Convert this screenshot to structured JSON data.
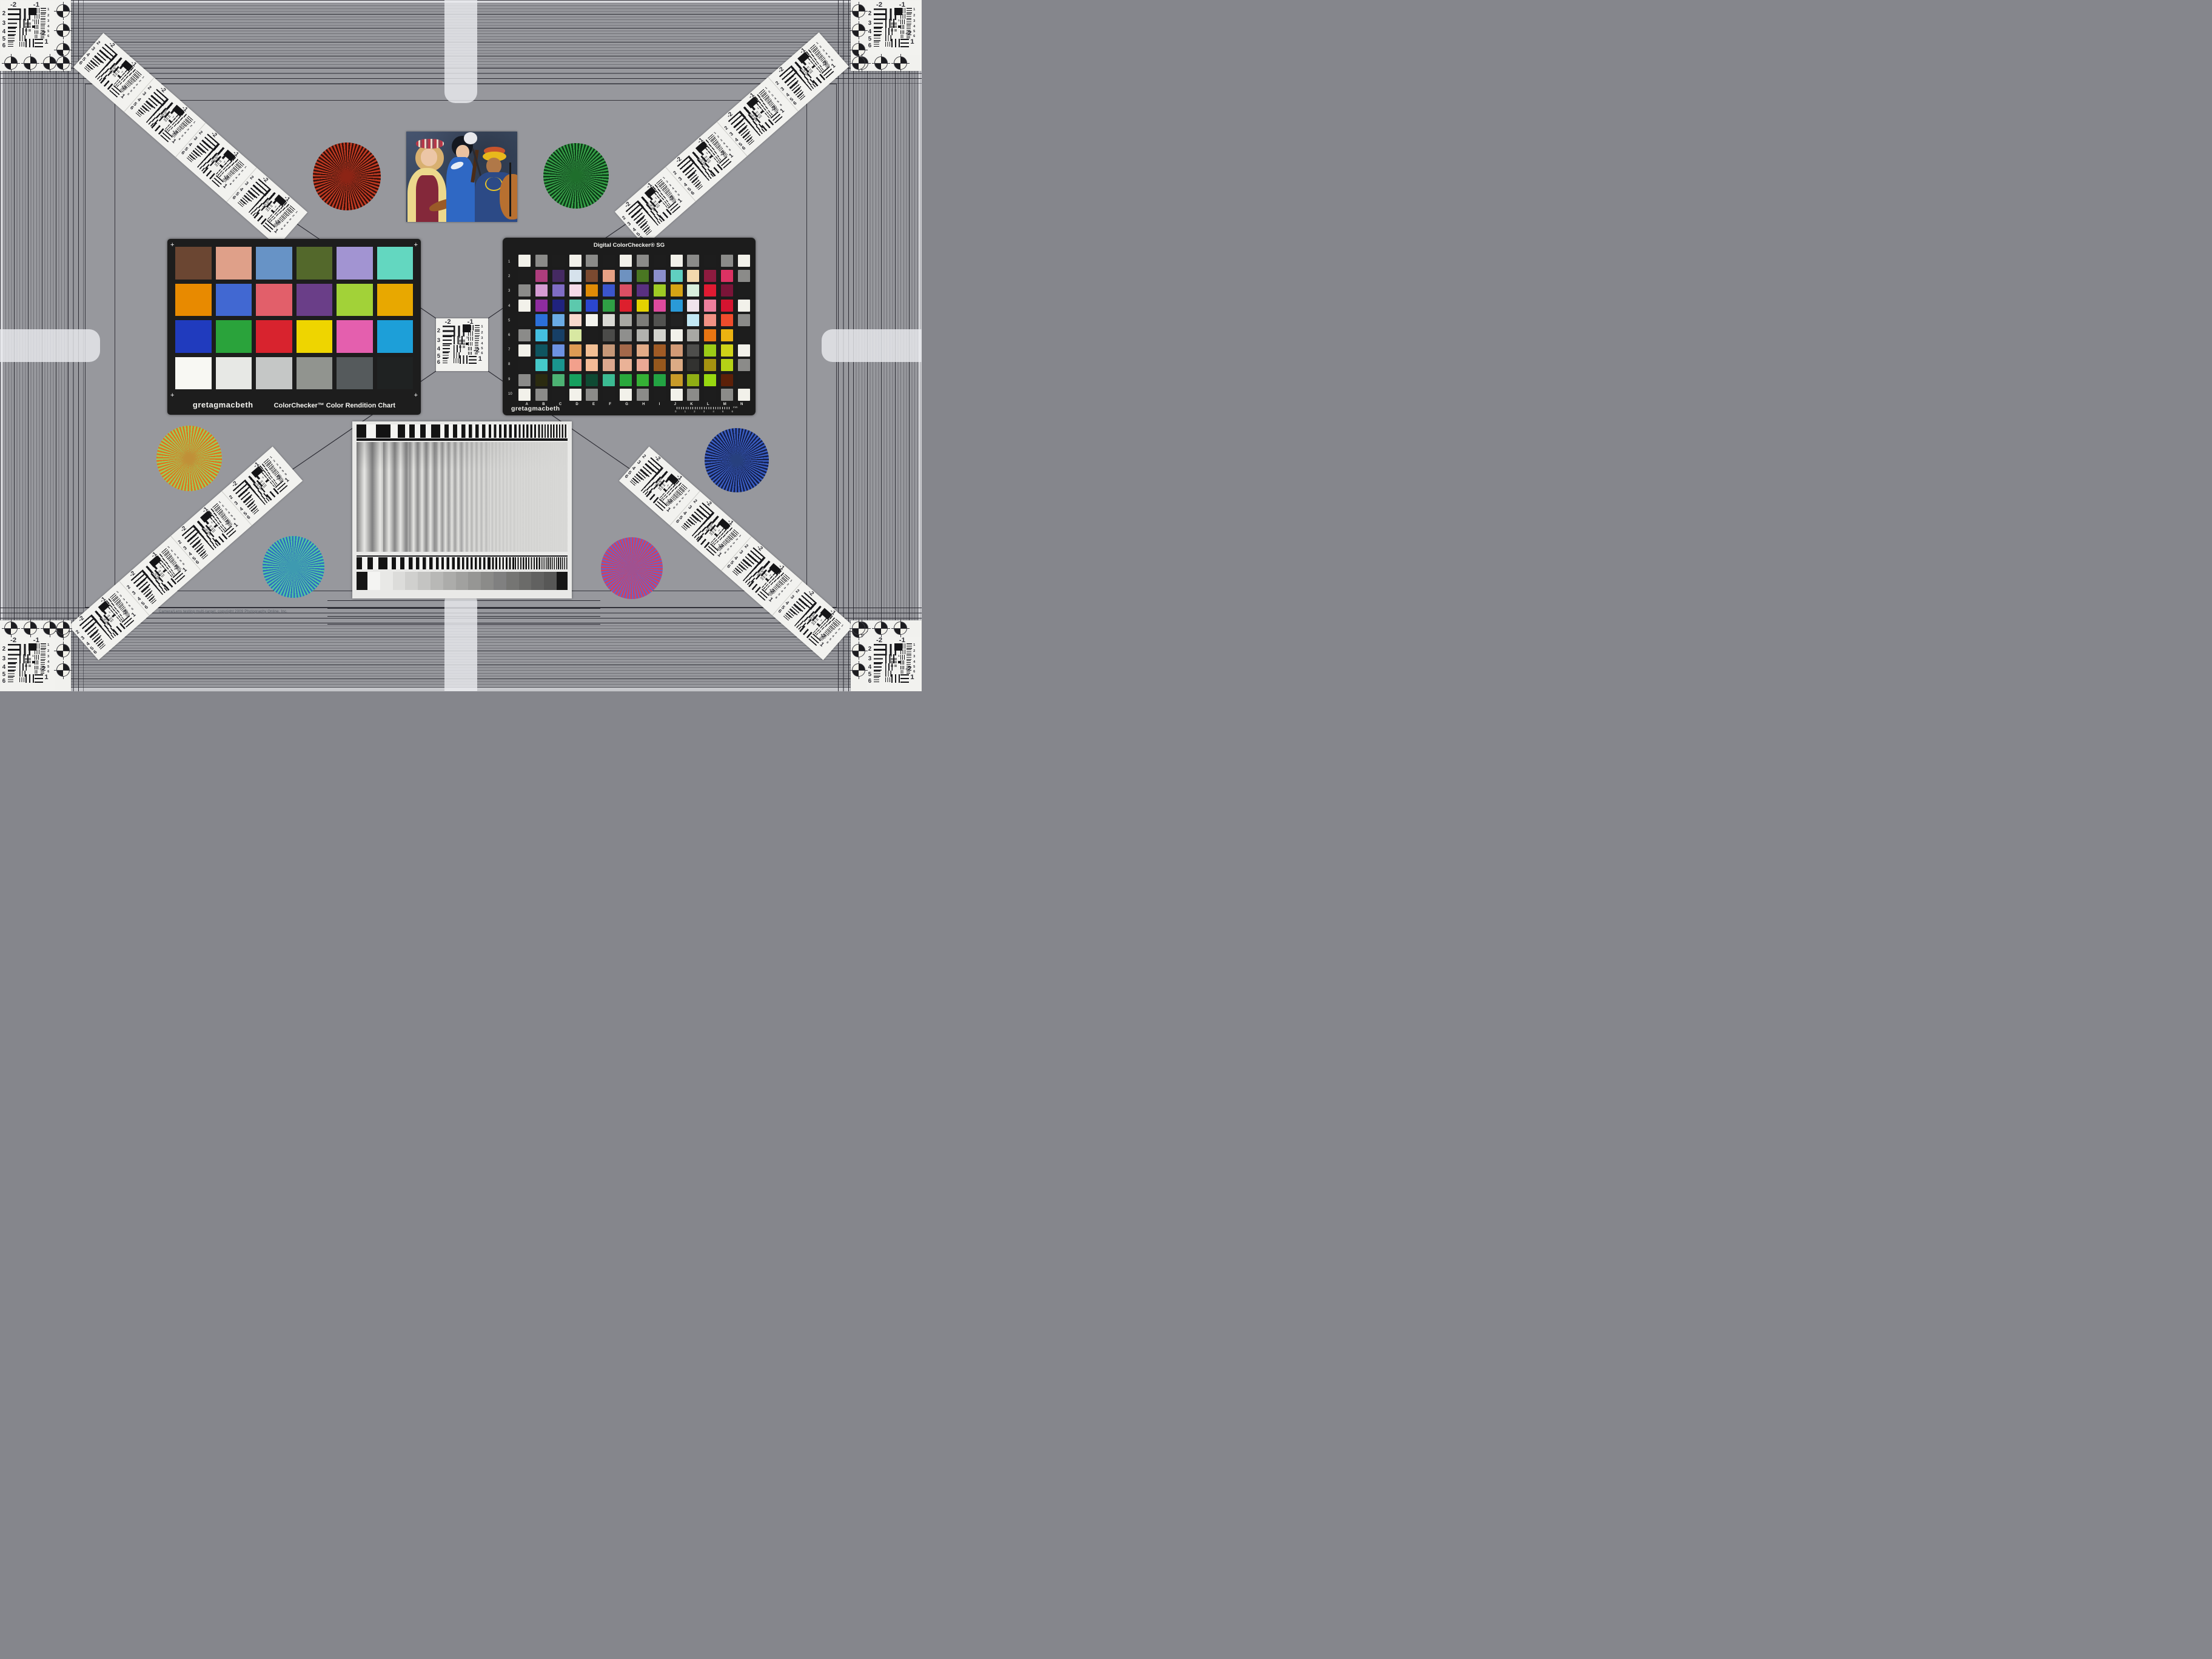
{
  "meta": {
    "copyright": "Camera/Lens testing multi-target, copyright 2009 Photography Online, Inc."
  },
  "colors": {
    "background": "#97989d",
    "border_line": "#23232a",
    "card_black": "#1d1d1d",
    "target_white": "#f2f2ef",
    "tab_white": "#ebecf0"
  },
  "colorchecker": {
    "brand": "gretagmacbeth",
    "title": "ColorChecker™ Color Rendition Chart",
    "corner_mark": "+",
    "patches": [
      "#6b4632",
      "#dfa089",
      "#6793c6",
      "#53682b",
      "#a294d2",
      "#63d7c0",
      "#e88a00",
      "#4168d2",
      "#e25f6a",
      "#6a3e88",
      "#a2d238",
      "#e8a800",
      "#203bbe",
      "#2aa33b",
      "#d8232e",
      "#eed500",
      "#e45fae",
      "#1d9fd8",
      "#f8f8f3",
      "#e7e8e5",
      "#c5c7c6",
      "#91948f",
      "#555a5c",
      "#1f2222"
    ]
  },
  "sg": {
    "title": "Digital ColorChecker® SG",
    "brand": "gretagmacbeth",
    "row_labels": [
      "1",
      "2",
      "3",
      "4",
      "5",
      "6",
      "7",
      "8",
      "9",
      "10"
    ],
    "col_labels": [
      "A",
      "B",
      "C",
      "D",
      "E",
      "F",
      "G",
      "H",
      "I",
      "J",
      "K",
      "L",
      "M",
      "N"
    ],
    "ruler_numbers": [
      "0",
      "1",
      "2",
      "3",
      "4",
      "5",
      "6"
    ],
    "ruler_unit": "mm",
    "grid": [
      [
        "#f2f1ea",
        "#8b8b89",
        "#1d1d1d",
        "#f2f1ea",
        "#8b8b89",
        "#1d1d1d",
        "#f2f1ea",
        "#8b8b89",
        "#1d1d1d",
        "#f2f1ea",
        "#8b8b89",
        "#1d1d1d",
        "#8b8b89",
        "#f2f1ea"
      ],
      [
        "#1d1d1d",
        "#ae3d7d",
        "#452a62",
        "#d6e2ec",
        "#7b4a30",
        "#e6a184",
        "#6e92c0",
        "#4a7722",
        "#8b8ecb",
        "#60cfc0",
        "#f2d9ad",
        "#8d1b3f",
        "#dc3263",
        "#8b8b89"
      ],
      [
        "#8b8b89",
        "#d59bd3",
        "#7f6cc4",
        "#f6dae8",
        "#e08b06",
        "#3b55cc",
        "#db4f64",
        "#593080",
        "#9ecb24",
        "#d6a414",
        "#d8efdc",
        "#e01a32",
        "#7a1438",
        "#1d1d1d"
      ],
      [
        "#f2f1ea",
        "#8e2c9f",
        "#20237e",
        "#5cc9ad",
        "#2b46cf",
        "#2f9f45",
        "#dd1f2d",
        "#e3d200",
        "#dd4a9d",
        "#2a9ad8",
        "#efe4ec",
        "#ec7f9d",
        "#d41430",
        "#f2f1ea"
      ],
      [
        "#1d1d1d",
        "#2b6fd9",
        "#6aabe4",
        "#f8d9cc",
        "#f4f4ee",
        "#d9d9d4",
        "#a8a8a3",
        "#7c7c78",
        "#525250",
        "#222222",
        "#c2e8f4",
        "#f29184",
        "#f04c2c",
        "#8b8b89"
      ],
      [
        "#8b8b89",
        "#44bfe0",
        "#173f66",
        "#d8e8a2",
        "#1d1d1d",
        "#4b4b49",
        "#8f8f8d",
        "#b2b2ae",
        "#d3d3cd",
        "#f2f1ea",
        "#a8a8a4",
        "#e87512",
        "#ecb211",
        "#1d1d1d"
      ],
      [
        "#f2f1ea",
        "#0f5560",
        "#6d92e2",
        "#dd9b54",
        "#f3c095",
        "#c69878",
        "#a3684a",
        "#e2ab87",
        "#a05b25",
        "#d29a76",
        "#4e4e4c",
        "#9ccc16",
        "#cfd318",
        "#f2f1ea"
      ],
      [
        "#1d1d1d",
        "#45c8c8",
        "#1a958e",
        "#f2a08c",
        "#f4bb97",
        "#dca88e",
        "#eab297",
        "#eaa895",
        "#96581d",
        "#dcab85",
        "#323230",
        "#a59310",
        "#b5d216",
        "#8b8b89"
      ],
      [
        "#8b8b89",
        "#2b2b10",
        "#4cb273",
        "#17a05e",
        "#0f4a33",
        "#3bba92",
        "#2aa83c",
        "#35b035",
        "#23a342",
        "#c89a28",
        "#8fae14",
        "#98d810",
        "#5c2008",
        "#1d1d1d"
      ],
      [
        "#f2f1ea",
        "#8b8b89",
        "#1d1d1d",
        "#f2f1ea",
        "#8b8b89",
        "#1d1d1d",
        "#f2f1ea",
        "#8b8b89",
        "#1d1d1d",
        "#f2f1ea",
        "#8b8b89",
        "#1d1d1d",
        "#8b8b89",
        "#f2f1ea"
      ]
    ]
  },
  "usaf": {
    "top_left": "-2",
    "top_right": "-1",
    "left_nums": [
      "2",
      "3",
      "4",
      "5",
      "6"
    ],
    "right_nums": [
      "1",
      "2",
      "3",
      "4",
      "5",
      "6"
    ],
    "center_nums": [
      "0",
      "1"
    ],
    "bottom_label": "-2",
    "bottom_num": "1"
  },
  "stars": [
    {
      "name": "red-star",
      "c1": "#c23a22",
      "c2": "#36100a",
      "blend": "#8c2415"
    },
    {
      "name": "green-star",
      "c1": "#36a048",
      "c2": "#0d3a17",
      "blend": "#1f6e2c"
    },
    {
      "name": "gold-star",
      "c1": "#e0741c",
      "c2": "#98cc60",
      "blend": "#c09038"
    },
    {
      "name": "blue-star",
      "c1": "#3a5ec4",
      "c2": "#141f49",
      "blend": "#27407e"
    },
    {
      "name": "teal-star",
      "c1": "#52c8a0",
      "c2": "#2e6cc0",
      "blend": "#3e9ab0"
    },
    {
      "name": "magenta-star",
      "c1": "#d84058",
      "c2": "#6a62c8",
      "blend": "#a05190"
    }
  ],
  "photo": {
    "backdrop": [
      "#46546e",
      "#3a4961",
      "#2e3c55"
    ],
    "figure_left": {
      "hair": "#d8b070",
      "skin": "#ecc6a6",
      "blouse": "#ecd88c",
      "vest": "#84283a",
      "violin": "#9a5a28"
    },
    "figure_middle": {
      "hair": "#141820",
      "headdress": "#e8e8ec",
      "skin": "#eac2a0",
      "kimono": "#2f68c4",
      "violin": "#4a2c18"
    },
    "figure_right": {
      "headband": "#e8b81c",
      "accent": "#c8542c",
      "skin": "#b07848",
      "dress": "#2c4a86",
      "necklace": "#e8c428",
      "cello": "#b87030"
    }
  },
  "sweep": {
    "top_half_pitches": [
      16,
      12,
      9,
      7,
      5.5,
      4.2,
      3.2,
      2.4
    ],
    "main_pitches": [
      26,
      19,
      14,
      10.5,
      8,
      6,
      4.6,
      3.6
    ],
    "bottom_half_pitches": [
      9,
      7,
      5.5,
      4.4,
      3.5,
      2.8,
      2.2,
      1.7
    ],
    "wedge_steps": [
      "#f4f4f2",
      "#e8e8e6",
      "#dcdcda",
      "#d0d0ce",
      "#c4c4c2",
      "#b8b8b6",
      "#acacaa",
      "#a1a19f",
      "#969694",
      "#8b8b89",
      "#808080",
      "#757573",
      "#6b6b69",
      "#616160",
      "#575756"
    ],
    "wedge_end": "#161616"
  }
}
